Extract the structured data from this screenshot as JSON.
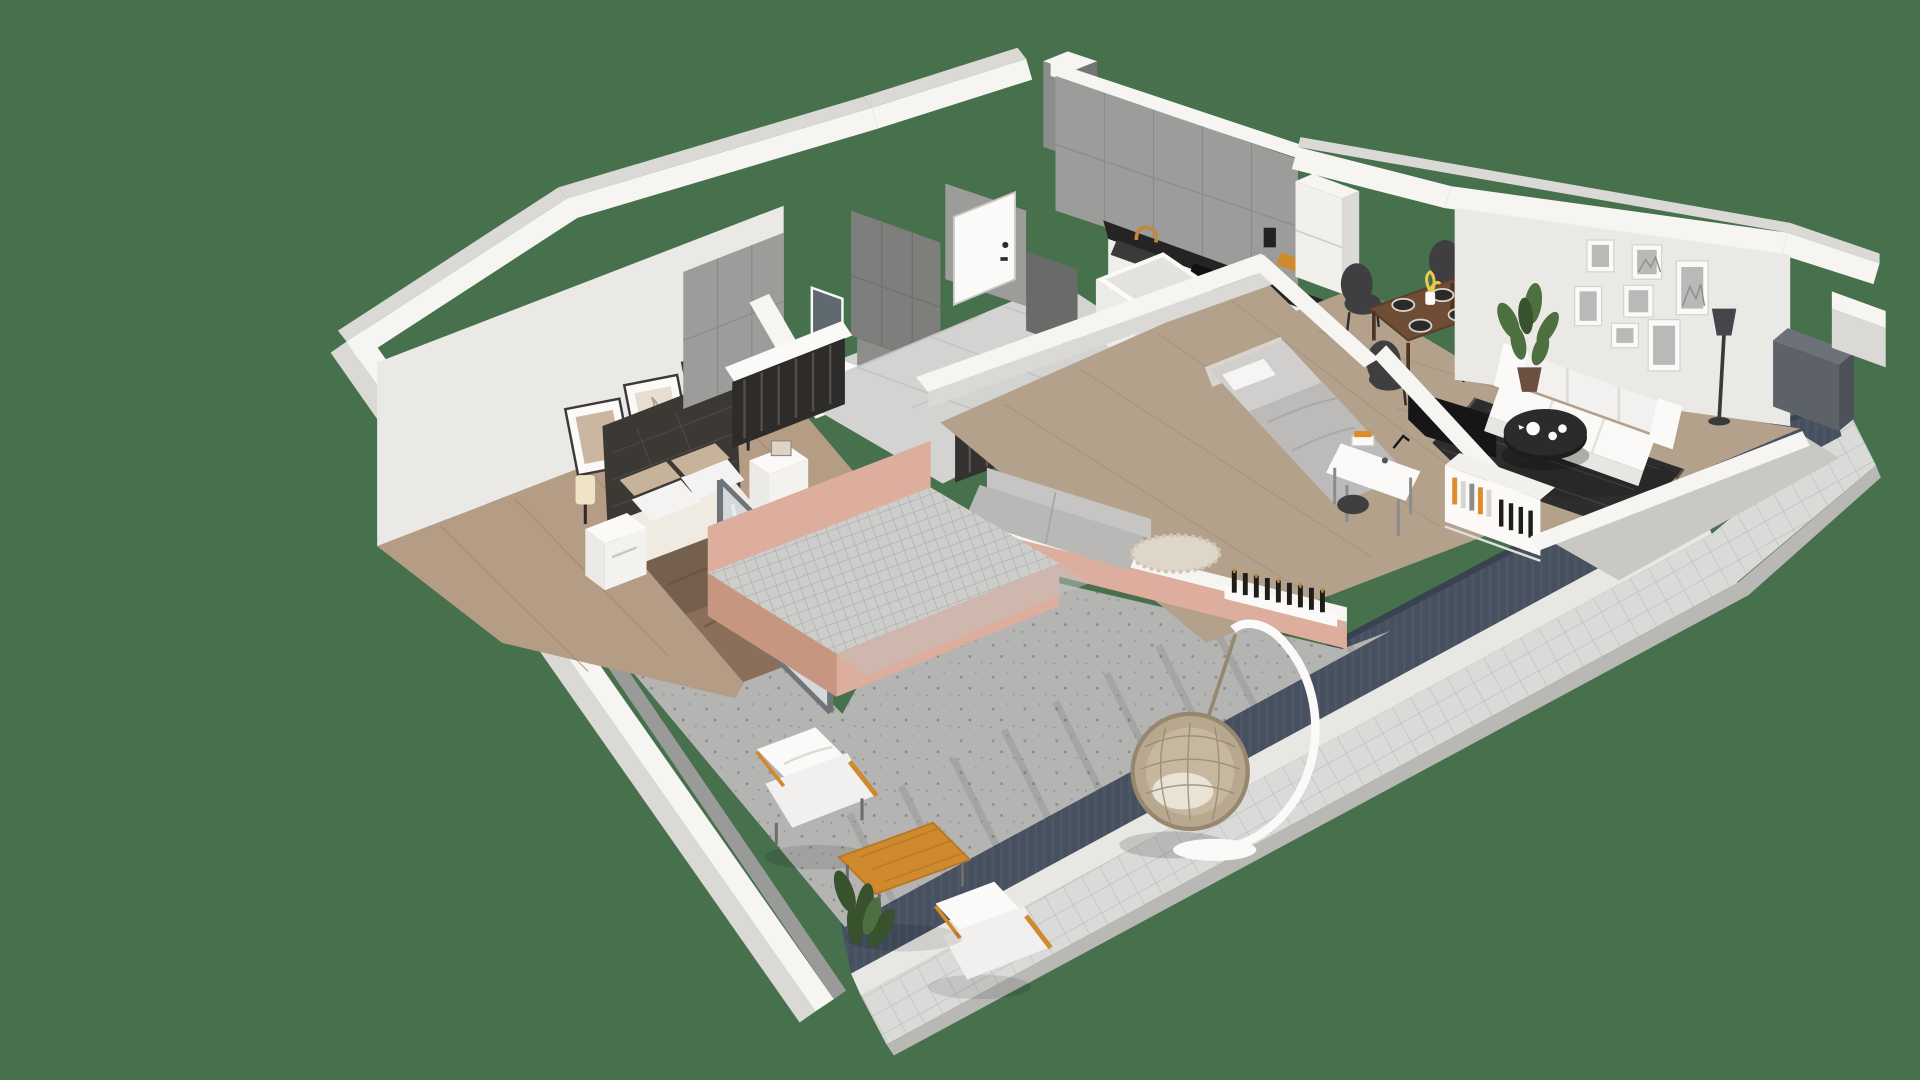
{
  "meta": {
    "type": "3d-floorplan-render",
    "style": "isometric cutaway apartment visualization",
    "visible_text": "none"
  },
  "colors": {
    "bg": "#47704d",
    "wallTop": "#f6f5f2",
    "wallFaceMid": "#dbd9d5",
    "wallFaceDark": "#bfbdb9",
    "wallInner": "#ebe9e5",
    "tileWall": "#9c9c9a",
    "tileWallDark": "#7e7e7c",
    "floorWoodA": "#b59c84",
    "floorWoodB": "#b3a18c",
    "floorTile": "#d3d3d1",
    "concrete": "#b4b4b2",
    "platformTile": "#cdcdcb",
    "salmon": "#ddad9d",
    "salmonShade": "#c69681",
    "railing": "#46505f",
    "railingLight": "#5a6575",
    "walkTile": "#dadad8",
    "curb": "#e8e7e4",
    "white": "#f7f6f4",
    "sofaWhite": "#f2f1ef",
    "rugDark": "#2d2d2d",
    "tableBlack": "#1d1d1d",
    "woodDining": "#6e4c36",
    "chairDark": "#3f3f41",
    "bedBrown": "#8a6f5a",
    "bedBrownDark": "#74604d",
    "headboard": "#3c3834",
    "pillowBeige": "#c7b29a",
    "grayBedding": "#d0cfcd",
    "plantGreen": "#4e7040",
    "plantDark": "#39522e",
    "rattan": "#b7a88f",
    "rattanDark": "#96876e",
    "woodOrange": "#d08a2e",
    "brass": "#c08a3e",
    "glass": "#c7ccce",
    "artBeige": "#cbb6a2",
    "bookOrange": "#e08a2a"
  },
  "rooms": [
    {
      "id": "master-bedroom",
      "name": "Master bedroom",
      "floor": "wood",
      "furniture": [
        "double-bed",
        "tufted-headboard",
        "nightstand-left",
        "nightstand-right",
        "wall-art-frames",
        "sconce-left",
        "sconce-right",
        "sliding-door"
      ]
    },
    {
      "id": "bathroom",
      "name": "Bathroom",
      "floor": "tile",
      "furniture": [
        "shower-wall",
        "mirror",
        "vanity",
        "low-cabinet"
      ]
    },
    {
      "id": "entry-hall",
      "name": "Entry hall",
      "floor": "tile",
      "furniture": [
        "entrance-door",
        "open-wardrobe",
        "coat-rail",
        "niche"
      ]
    },
    {
      "id": "kitchen",
      "name": "Kitchen",
      "floor": "tile",
      "furniture": [
        "counter-run",
        "cooktop",
        "oven",
        "sink",
        "faucet",
        "tall-cabinet",
        "island-block",
        "cutting-board"
      ]
    },
    {
      "id": "dining",
      "name": "Dining area",
      "floor": "wood",
      "furniture": [
        "dining-table",
        "dining-chairs",
        "placemats",
        "flower-vase"
      ]
    },
    {
      "id": "living-room",
      "name": "Living room",
      "floor": "wood",
      "furniture": [
        "sofa",
        "gallery-wall-frames",
        "area-rug",
        "coffee-table",
        "tea-set",
        "potted-plant",
        "floor-lamp",
        "tv-panel"
      ]
    },
    {
      "id": "guest-room",
      "name": "Guest room / office",
      "floor": "wood",
      "furniture": [
        "single-bed",
        "desk",
        "desk-chair",
        "bookshelf",
        "wine-rack",
        "lounge-couch",
        "shag-rug",
        "window-wine-ledge"
      ]
    },
    {
      "id": "terrace",
      "name": "Terrace",
      "floor": "concrete",
      "furniture": [
        "tiled-platform",
        "egg-chair",
        "outdoor-armchair-a",
        "outdoor-armchair-b",
        "outdoor-table",
        "terrace-plant",
        "railing",
        "exterior-walkway"
      ]
    },
    {
      "id": "side-balcony",
      "name": "Side balcony",
      "floor": "tile",
      "furniture": [
        "balcony-cabinet",
        "divider-wall"
      ]
    }
  ]
}
